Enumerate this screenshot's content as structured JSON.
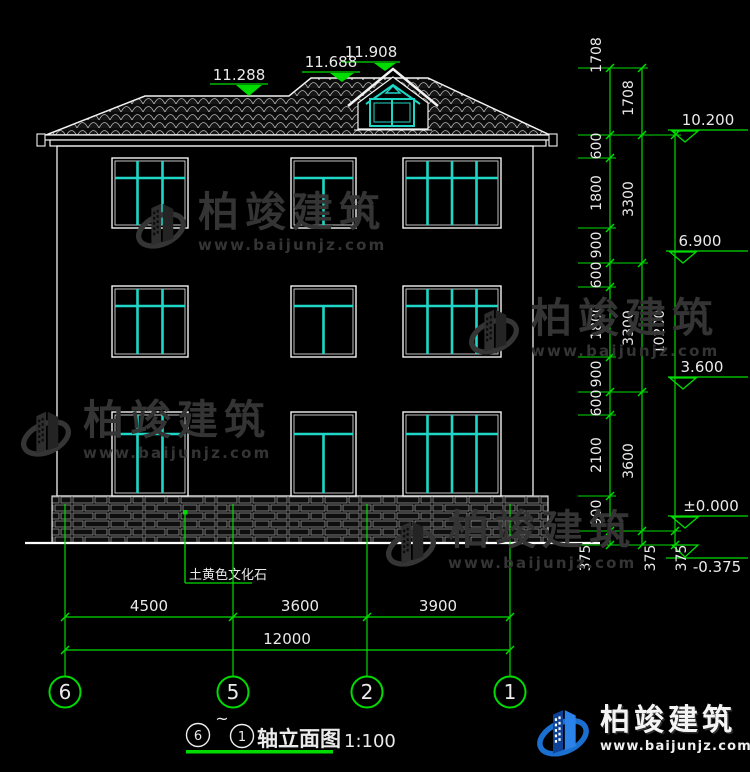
{
  "watermark": {
    "brand": "柏竣建筑",
    "url": "www.baijunjz.com"
  },
  "footer_logo": {
    "brand": "柏竣建筑",
    "url": "www.baijunjz.com"
  },
  "title_block": {
    "axis_start": "6",
    "tilde": "~",
    "axis_end": "1",
    "name": "轴立面图",
    "scale": "1:100"
  },
  "notes": {
    "plinth_material": "土黄色文化石"
  },
  "roof_levels": [
    "11.288",
    "11.688",
    "11.908"
  ],
  "right_levels": [
    "10.200",
    "6.900",
    "3.600",
    "±0.000",
    "-0.375"
  ],
  "axis_bubbles": [
    "6",
    "5",
    "2",
    "1"
  ],
  "dims": {
    "bottom_segments": [
      "4500",
      "3600",
      "3900"
    ],
    "bottom_total": "12000",
    "chain_inner": [
      "1708",
      "600",
      "1800",
      "900",
      "600",
      "1800",
      "900",
      "600",
      "2100",
      "900",
      "375"
    ],
    "chain_mid": [
      "1708",
      "3300",
      "3300",
      "3600",
      "375"
    ],
    "chain_outer": [
      "10200",
      "375"
    ]
  },
  "colors": {
    "dim_green": "#00dc00",
    "frame_white": "#f2f2f2",
    "glass_cyan": "#1fd6c6",
    "watermark_gray": "#343434",
    "logo_blue": "#1b6fd0"
  }
}
